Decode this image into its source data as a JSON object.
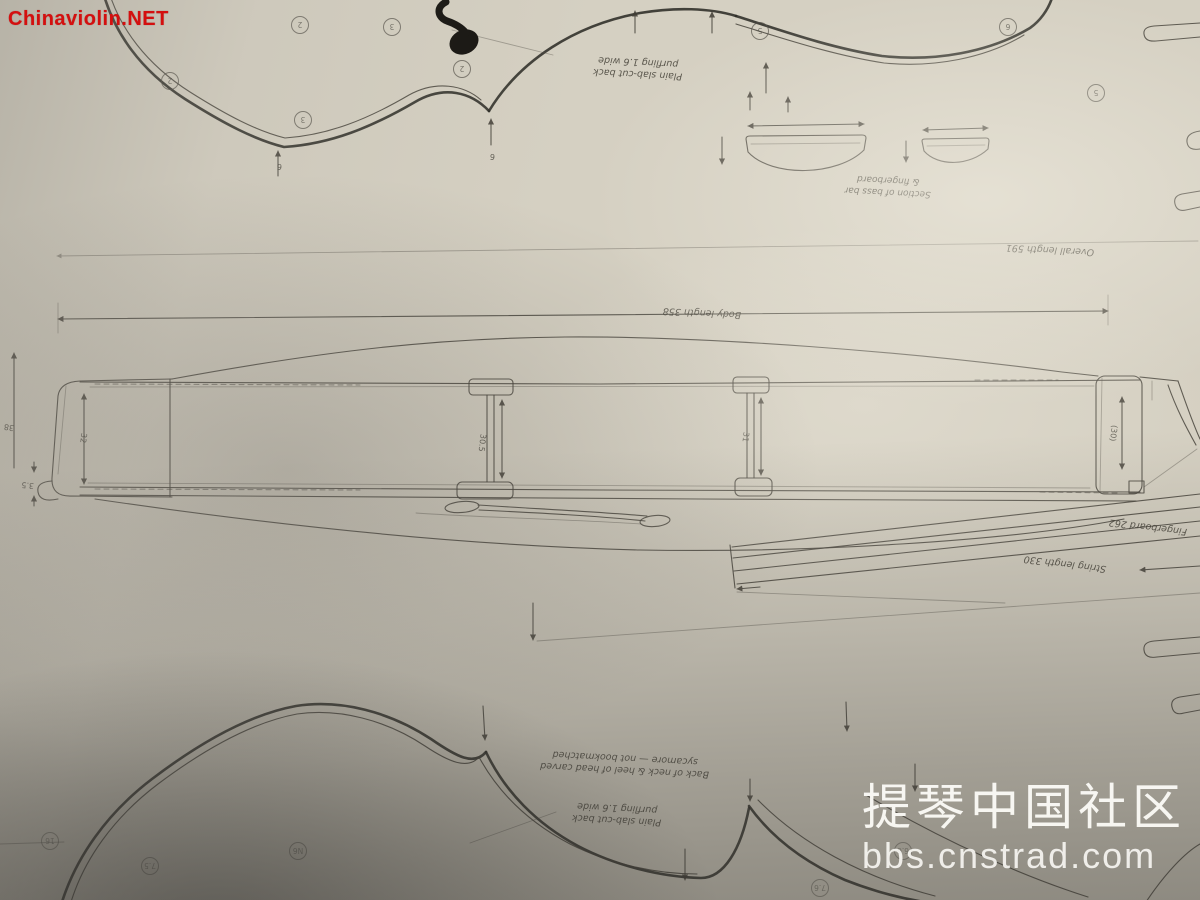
{
  "photo": {
    "subject": "Hand-drawn violin making plan (blueprint sheet) photographed lying rotated 180 degrees, with soft shadows over the paper",
    "paper_color": "#d8d3c5",
    "ink_color": "#45423a"
  },
  "watermarks": {
    "top_left": {
      "text": "Chinaviolin.NET",
      "color": "#d40f0f"
    },
    "bottom_right": {
      "line1": "提琴中国社区",
      "line2": "bbs.cnstrad.com",
      "color": "#f5f4f0"
    }
  },
  "notes": {
    "top_back": {
      "line1": "Plain slab-cut back",
      "line2": "purfling 1.6 wide"
    },
    "bassbar_section": {
      "line1": "Section of bass bar",
      "line2": "& fingerboard"
    },
    "neck_heel": {
      "line1": "Back of neck & heel of head carved",
      "line2": "sycamore — not bookmatched"
    },
    "bottom_back": {
      "line1": "Plain slab-cut back",
      "line2": "purfling 1.6 wide"
    }
  },
  "dimensions": {
    "overall_length": "Overall length 591",
    "body_length": "Body length 358",
    "fingerboard_length": "Fingerboard 262",
    "string_length": "String length 330",
    "edge_left_outer": "38",
    "overhang_left": "3.5",
    "rib_left": "32",
    "rib_strut1": "30.5",
    "rib_strut2": "31",
    "rib_neck": "(30)",
    "tick_a": "6",
    "tick_b": "6"
  },
  "circles": [
    "2",
    "3",
    "2",
    "3",
    "2",
    "5",
    "6",
    "5",
    "16",
    "7.5",
    "N6",
    "6.6",
    "7.6"
  ]
}
